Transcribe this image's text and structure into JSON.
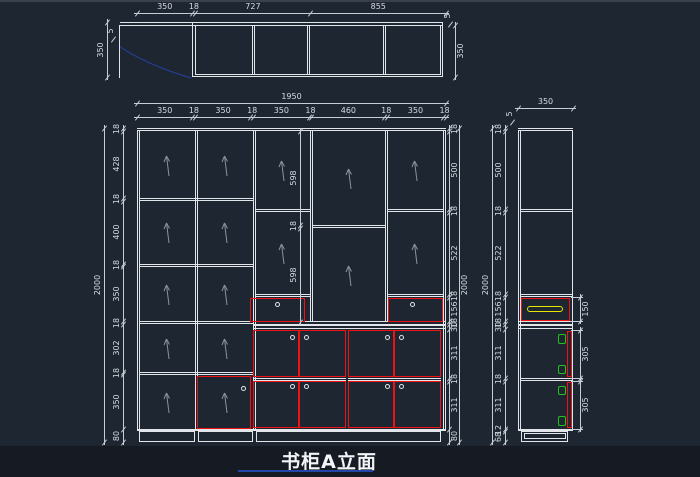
{
  "title": {
    "text": "书柜A立面"
  },
  "colors": {
    "background": "#1e2631",
    "bottom_band": "#151a23",
    "line": "#e2e6eb",
    "dim_line": "#c7cdd6",
    "dim_text": "#d6dbe2",
    "red": "#ee1212",
    "green": "#1ec41e",
    "yellow": "#e6e600",
    "blue": "#2245a8",
    "arrow": "#8b93a0"
  },
  "plan_view": {
    "dims_top": [
      "350",
      "18",
      "727",
      "855"
    ],
    "dim_left": "350",
    "dim_right": "350",
    "dim_panel_left": "5",
    "dim_panel_right": "5"
  },
  "elevation": {
    "dim_overall_width": "1950",
    "dims_top": [
      "350",
      "18",
      "350",
      "18",
      "350",
      "18",
      "460",
      "18",
      "350",
      "18"
    ],
    "dim_overall_height": "2000",
    "dims_left": [
      "18",
      "428",
      "18",
      "400",
      "18",
      "350",
      "18",
      "302",
      "18",
      "350",
      "80"
    ],
    "dims_right": [
      "18",
      "500",
      "18",
      "522",
      "18",
      "156",
      "18",
      "30",
      "311",
      "18",
      "311",
      "80"
    ],
    "dims_middle": [
      "598",
      "18",
      "598"
    ]
  },
  "side_view": {
    "dim_width": "350",
    "dim_panel": "5",
    "dim_overall_height": "2000",
    "dims_left": [
      "18",
      "500",
      "18",
      "522",
      "18",
      "156",
      "18",
      "30",
      "311",
      "18",
      "311",
      "12",
      "68"
    ],
    "dims_right": [
      "150",
      "305",
      "305"
    ]
  }
}
